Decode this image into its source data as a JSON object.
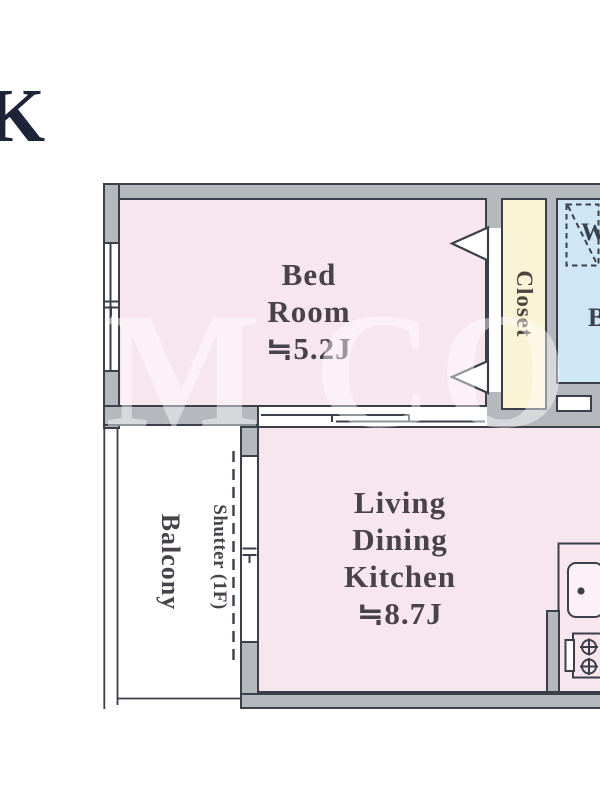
{
  "page": {
    "title_fragment": "K"
  },
  "watermark": {
    "text": "M CO"
  },
  "floorplan": {
    "bedroom": {
      "lines": [
        "Bed",
        "Room",
        "≒5.2J"
      ]
    },
    "ldk": {
      "lines": [
        "Living",
        "Dining",
        "Kitchen",
        "≒8.7J"
      ]
    },
    "closet": {
      "label": "Closet"
    },
    "balcony": {
      "label": "Balcony"
    },
    "shutter": {
      "label": "Shutter (1F)"
    },
    "washer_symbol": {
      "label": "W"
    },
    "cutoff_room_label_fragment": "B",
    "colors": {
      "wall_fill": "#b5b8bd",
      "wall_line": "#3a3f49",
      "room_pink": "#f8e6ee",
      "closet_cream": "#faf3d6",
      "wet_area_blue": "#cfe7f5",
      "label_text": "#48424a",
      "title_navy": "#1d2438"
    }
  }
}
